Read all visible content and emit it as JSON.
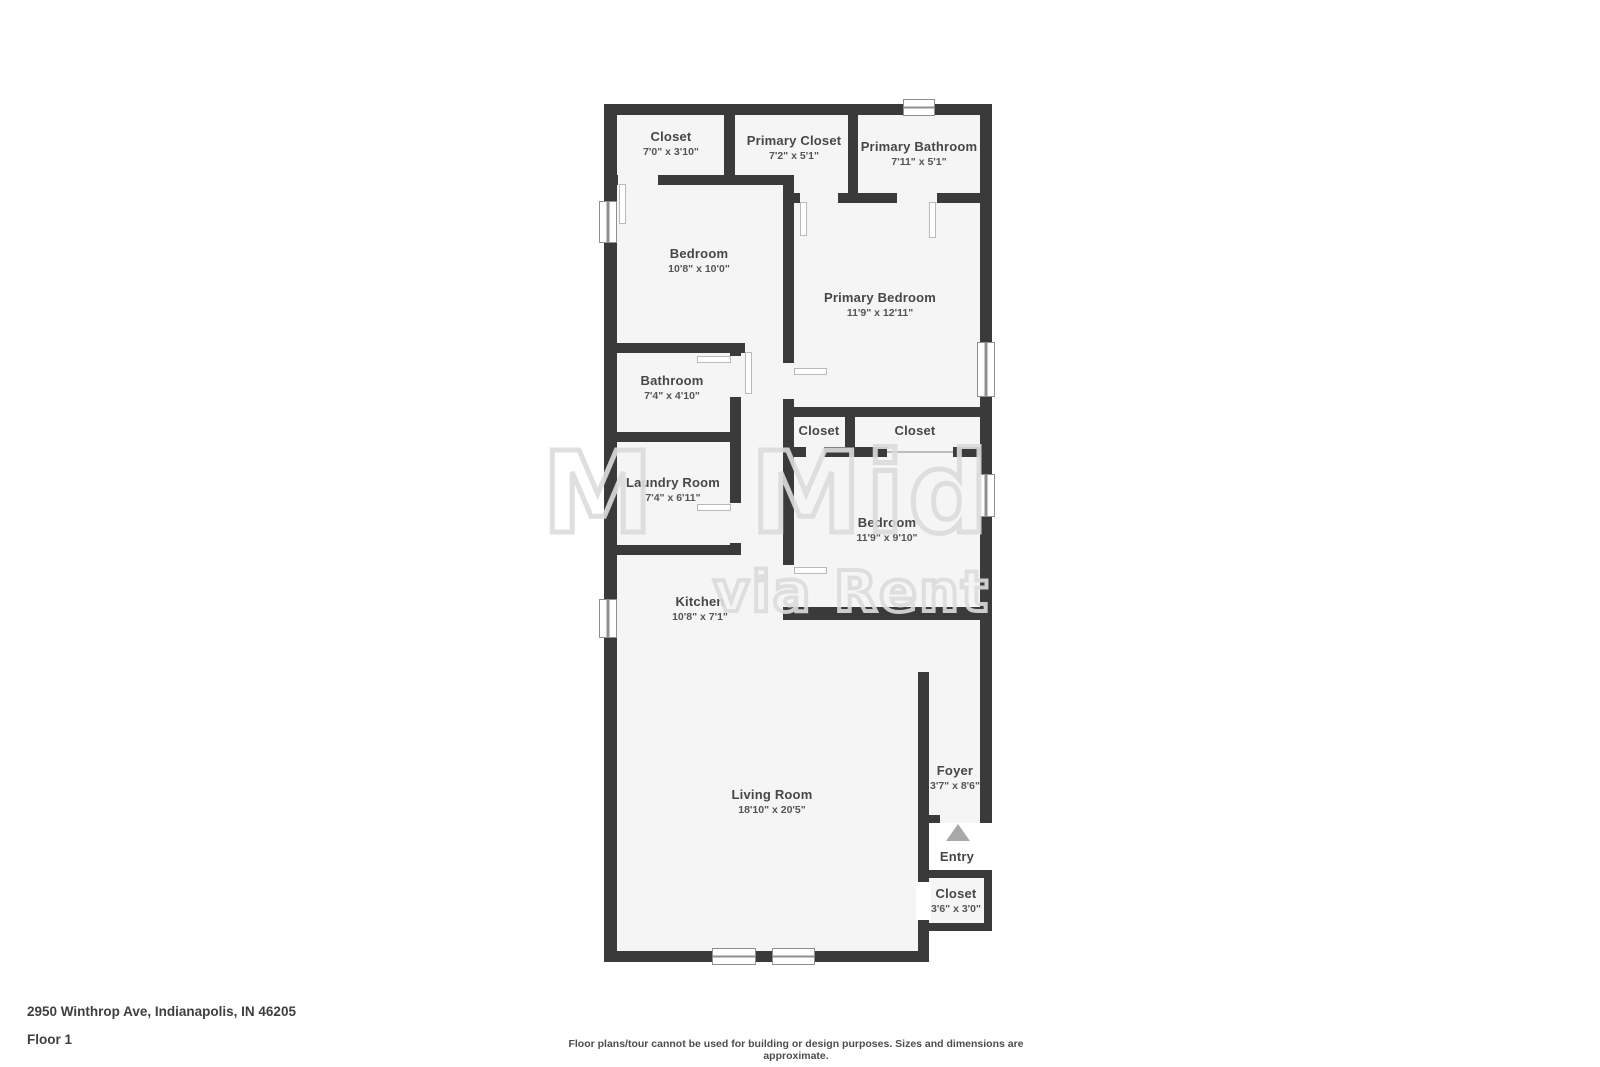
{
  "rooms": {
    "closet_tl": {
      "name": "Closet",
      "dims": "7'0\" x 3'10\""
    },
    "primary_closet": {
      "name": "Primary Closet",
      "dims": "7'2\" x 5'1\""
    },
    "primary_bathroom": {
      "name": "Primary Bathroom",
      "dims": "7'11\" x 5'1\""
    },
    "bedroom_tl": {
      "name": "Bedroom",
      "dims": "10'8\" x 10'0\""
    },
    "primary_bedroom": {
      "name": "Primary Bedroom",
      "dims": "11'9\" x 12'11\""
    },
    "bathroom": {
      "name": "Bathroom",
      "dims": "7'4\" x 4'10\""
    },
    "closet_hall_left": {
      "name": "Closet"
    },
    "closet_hall_right": {
      "name": "Closet"
    },
    "laundry": {
      "name": "Laundry Room",
      "dims": "7'4\" x 6'11\""
    },
    "bedroom2": {
      "name": "Bedroom",
      "dims": "11'9\" x 9'10\""
    },
    "kitchen": {
      "name": "Kitchen",
      "dims": "10'8\" x 7'1\""
    },
    "living_room": {
      "name": "Living Room",
      "dims": "18'10\" x 20'5\""
    },
    "foyer": {
      "name": "Foyer",
      "dims": "3'7\" x 8'6\""
    },
    "closet_entry": {
      "name": "Closet",
      "dims": "3'6\" x 3'0\""
    },
    "entry": {
      "name": "Entry"
    }
  },
  "watermark": {
    "line1": "M Midw",
    "line2": "via RentEngin"
  },
  "footer": {
    "address": "2950 Winthrop Ave, Indianapolis, IN 46205",
    "floor": "Floor 1",
    "disclaimer": "Floor plans/tour cannot be used for building or design purposes. Sizes and dimensions are approximate."
  },
  "colors": {
    "wall": "#3a3a3a",
    "floor": "#f5f5f5",
    "label": "#474747",
    "dims": "#555555",
    "window_frame": "#8f8f8f",
    "entry_arrow": "#a8a8a8",
    "watermark": "#dcdcdc",
    "footer_text": "#3f3f3f"
  }
}
